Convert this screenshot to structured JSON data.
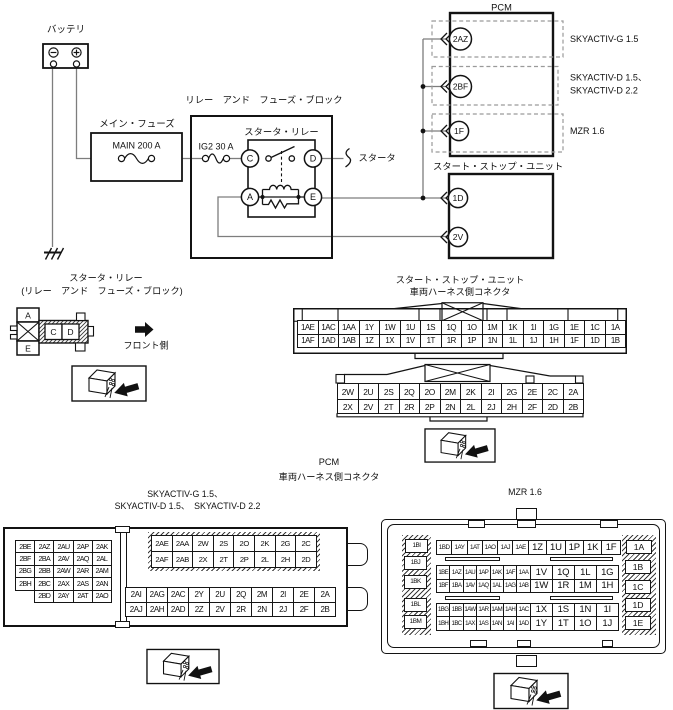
{
  "top": {
    "battery": "バッテリ",
    "main_fuse_label": "メイン・フューズ",
    "main_fuse_value": "MAIN 200 A",
    "ig2_fuse": "IG2 30 A",
    "relay_block": "リレー　アンド　フューズ・ブロック",
    "starter_relay": "スタータ・リレー",
    "terminals": {
      "c": "C",
      "d": "D",
      "a": "A",
      "e": "E"
    },
    "starter": "スタータ",
    "pcm": "PCM",
    "pins": {
      "p2az": "2AZ",
      "p2bf": "2BF",
      "p1f": "1F",
      "p1d": "1D",
      "p2v": "2V"
    },
    "variant_g15": "SKYACTIV-G 1.5",
    "variant_d_1": "SKYACTIV-D 1.5、",
    "variant_d_2": "SKYACTIV-D 2.2",
    "variant_mzr": "MZR 1.6",
    "ssu": "スタート・ストップ・ユニット"
  },
  "relay_view": {
    "title1": "スタータ・リレー",
    "title2": "(リレー　アンド　フューズ・ブロック)",
    "cell_a": "A",
    "cell_c": "C",
    "cell_d": "D",
    "cell_e": "E",
    "front": "フロント側"
  },
  "ss_table": {
    "title1": "スタート・ストップ・ユニット",
    "title2": "車両ハーネス側コネクタ",
    "rows": [
      [
        "1AE",
        "1AC",
        "1AA",
        "1Y",
        "1W",
        "1U",
        "1S",
        "1Q",
        "1O",
        "1M",
        "1K",
        "1I",
        "1G",
        "1E",
        "1C",
        "1A"
      ],
      [
        "1AF",
        "1AD",
        "1AB",
        "1Z",
        "1X",
        "1V",
        "1T",
        "1R",
        "1P",
        "1N",
        "1L",
        "1J",
        "1H",
        "1F",
        "1D",
        "1B"
      ]
    ]
  },
  "pcm_table": {
    "title1": "PCM",
    "title2": "車両ハーネス側コネクタ",
    "rows": [
      [
        "2W",
        "2U",
        "2S",
        "2Q",
        "2O",
        "2M",
        "2K",
        "2I",
        "2G",
        "2E",
        "2C",
        "2A"
      ],
      [
        "2X",
        "2V",
        "2T",
        "2R",
        "2P",
        "2N",
        "2L",
        "2J",
        "2H",
        "2F",
        "2D",
        "2B"
      ]
    ]
  },
  "sky": {
    "title1": "SKYACTIV-G 1.5、",
    "title2": "SKYACTIV-D 1.5、　SKYACTIV-D 2.2",
    "left": [
      [
        "2BE",
        "2AZ",
        "2AU",
        "2AP",
        "2AK"
      ],
      [
        "2BF",
        "2BA",
        "2AV",
        "2AQ",
        "2AL"
      ],
      [
        "2BG",
        "2BB",
        "2AW",
        "2AR",
        "2AM"
      ],
      [
        "2BH",
        "2BC",
        "2AX",
        "2AS",
        "2AN"
      ],
      [
        "",
        "2BD",
        "2AY",
        "2AT",
        "2AO"
      ]
    ],
    "top_right": [
      [
        "2AE",
        "2AA",
        "2W",
        "2S",
        "2O",
        "2K",
        "2G",
        "2C"
      ],
      [
        "2AF",
        "2AB",
        "2X",
        "2T",
        "2P",
        "2L",
        "2H",
        "2D"
      ]
    ],
    "bottom_right": [
      [
        "2AI",
        "2AG",
        "2AC",
        "2Y",
        "2U",
        "2Q",
        "2M",
        "2I",
        "2E",
        "2A"
      ],
      [
        "2AJ",
        "2AH",
        "2AD",
        "2Z",
        "2V",
        "2R",
        "2N",
        "2J",
        "2F",
        "2B"
      ]
    ]
  },
  "mzr": {
    "title": "MZR 1.6",
    "left_col": [
      "1BI",
      "1BJ",
      "1BK",
      "1BL",
      "1BM"
    ],
    "right_col": [
      "1A",
      "1B",
      "1C",
      "1D",
      "1E"
    ],
    "r1s": [
      "1BD",
      "1AY",
      "1AT",
      "1AO",
      "1AJ",
      "1AE"
    ],
    "r1l": [
      "1Z",
      "1U",
      "1P",
      "1K",
      "1F"
    ],
    "r2s": [
      "1BE",
      "1AZ",
      "1AU",
      "1AP",
      "1AK",
      "1AF",
      "1AA"
    ],
    "r2l": [
      "1V",
      "1Q",
      "1L",
      "1G"
    ],
    "r3s": [
      "1BF",
      "1BA",
      "1AV",
      "1AQ",
      "1AL",
      "1AG",
      "1AB"
    ],
    "r3l": [
      "1W",
      "1R",
      "1M",
      "1H"
    ],
    "r4s": [
      "1BG",
      "1BB",
      "1AW",
      "1AR",
      "1AM",
      "1AH",
      "1AC"
    ],
    "r4l": [
      "1X",
      "1S",
      "1N",
      "1I"
    ],
    "r5s": [
      "1BH",
      "1BC",
      "1AX",
      "1AS",
      "1AN",
      "1AI",
      "1AD"
    ],
    "r5l": [
      "1Y",
      "1T",
      "1O",
      "1J"
    ]
  }
}
